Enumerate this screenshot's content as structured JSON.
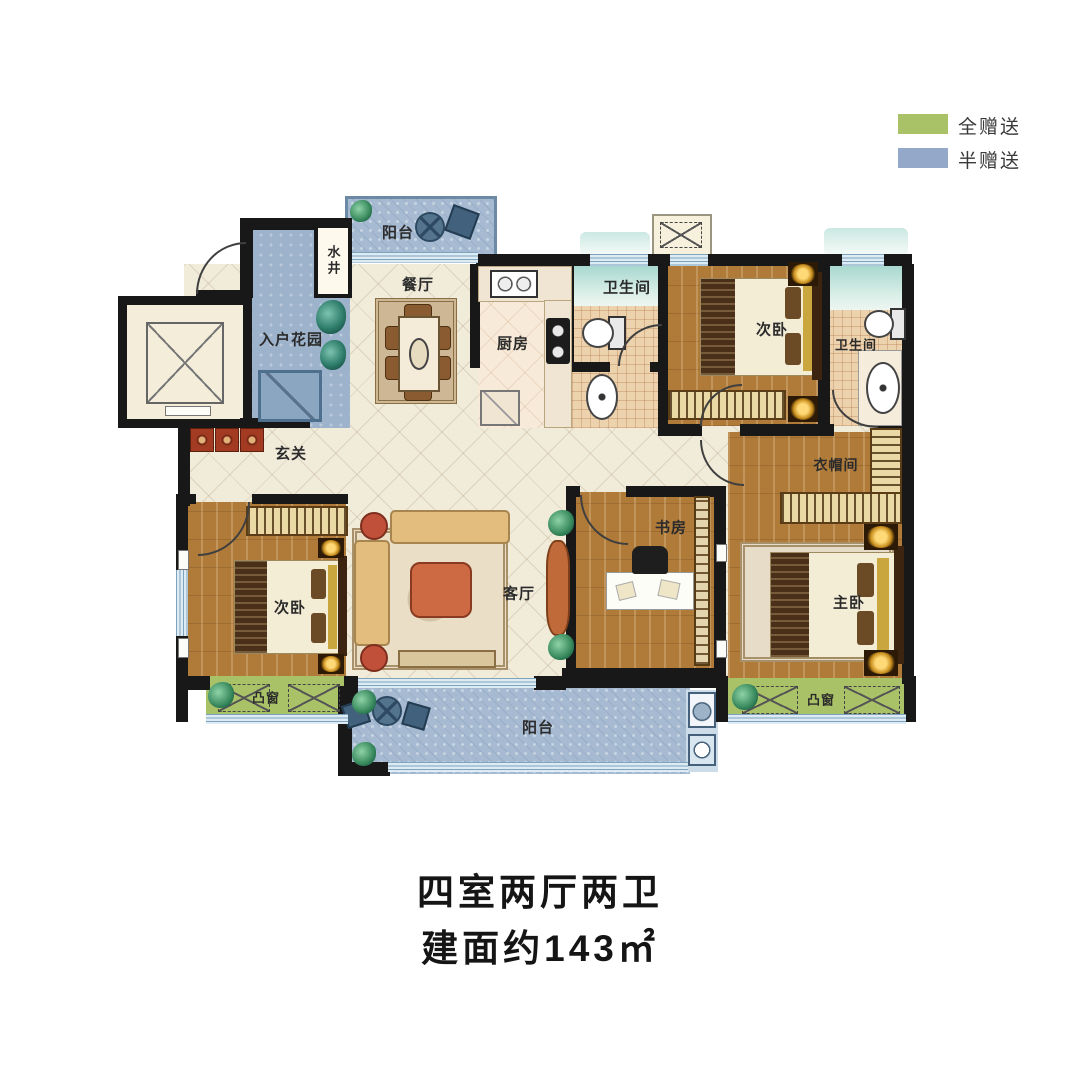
{
  "legend": {
    "full_gift": {
      "label": "全赠送",
      "color": "#a9c167"
    },
    "half_gift": {
      "label": "半赠送",
      "color": "#94a9c9"
    }
  },
  "rooms": {
    "balcony_top": "阳台",
    "water_well": "水井",
    "entry_garden": "入户花园",
    "dining_room": "餐厅",
    "kitchen": "厨房",
    "bathroom_top": "卫生间",
    "bedroom_top": "次卧",
    "bathroom_right": "卫生间",
    "foyer": "玄关",
    "cloakroom": "衣帽间",
    "bedroom_left": "次卧",
    "living_room": "客厅",
    "study": "书房",
    "master_bedroom": "主卧",
    "bay_window_left": "凸窗",
    "bay_window_right": "凸窗",
    "balcony_bottom": "阳台"
  },
  "caption": {
    "line1": "四室两厅两卫",
    "line2": "建面约143㎡"
  }
}
